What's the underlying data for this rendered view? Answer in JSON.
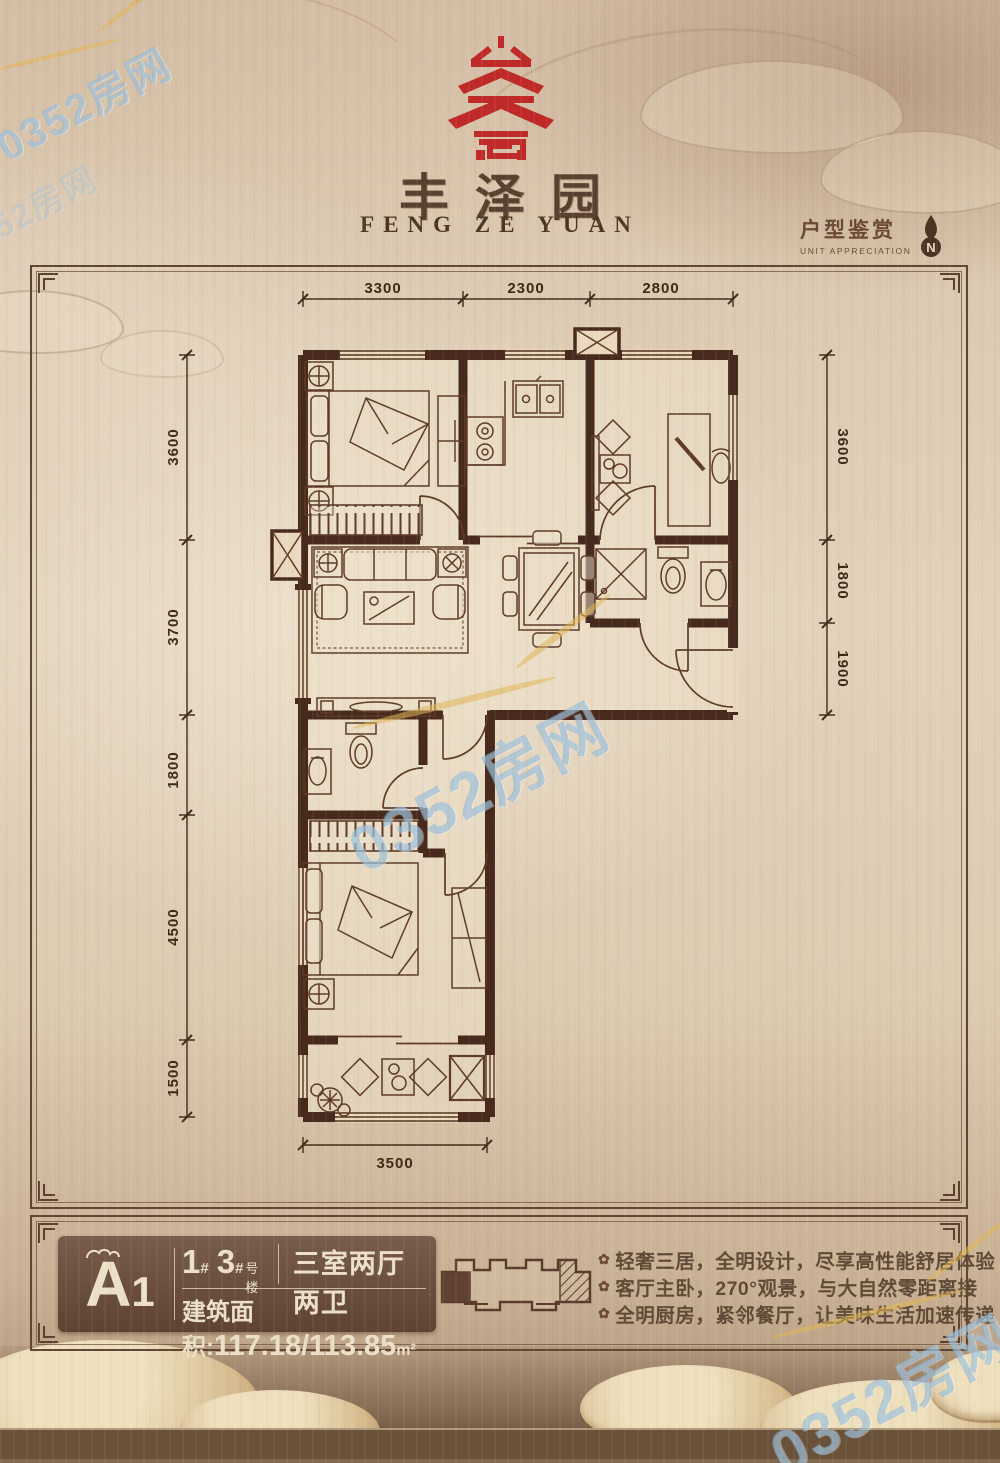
{
  "brand": {
    "emblem": "red-seal-pagoda-emblem",
    "title_cn": "丰泽园",
    "title_en": "FENG ZE YUAN"
  },
  "section": {
    "title": "户型鉴赏",
    "subtitle": "UNIT APPRECIATION",
    "compass": "N"
  },
  "plan": {
    "dims_top": [
      "3300",
      "2300",
      "2800"
    ],
    "dims_left": [
      "3600",
      "3700",
      "1800",
      "4500",
      "1500"
    ],
    "dims_right": [
      "3600",
      "1800",
      "1900"
    ],
    "dims_bottom": [
      "3500"
    ]
  },
  "info": {
    "unit_letter": "A",
    "unit_digit": "1",
    "buildings": [
      "1",
      "3"
    ],
    "hash": "#",
    "buildings_suffix": "号楼",
    "layout": "三室两厅两卫",
    "area_label": "建筑面积:",
    "area_value": "117.18/113.85",
    "area_unit": "m²",
    "features": [
      "轻奢三居，全明设计，尽享高性能舒居体验",
      "客厅主卧，270°观景，与大自然零距离接",
      "全明厨房，紧邻餐厅，让美味生活加速传递"
    ],
    "bullet_icon": "✿"
  },
  "watermark": {
    "text": "0352房网"
  },
  "colors": {
    "accent_red": "#bf2a28",
    "wall_brown": "#47291d",
    "panel_brown": "#6a4e3e",
    "cream": "#ece0c8",
    "watermark_blue": "#84b0d4"
  }
}
